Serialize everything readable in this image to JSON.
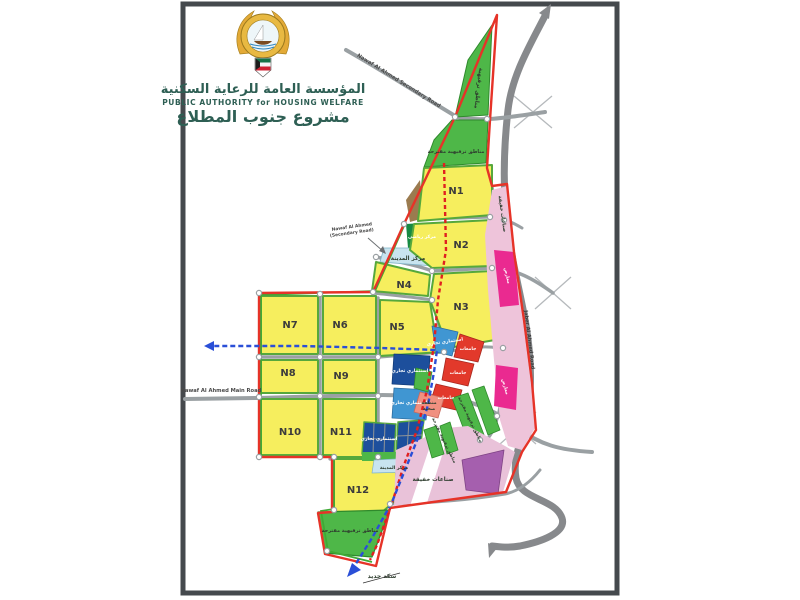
{
  "header": {
    "org_name_ar": "المؤسسة العامة للرعاية السكنية",
    "org_name_en": "PUBLIC AUTHORITY for HOUSING WELFARE",
    "project_name_ar": "مشروع جنوب المطلاع"
  },
  "roads": {
    "nawaf_secondary_top": "Nawaf Al Ahmed Secondary Road",
    "nawaf_secondary_l1": "Nawaf Al Ahmed",
    "nawaf_secondary_l2": "(Secondary Road)",
    "nawaf_main": "Nawaf Al Ahmed Main Road",
    "jaber": "Jaber Al Ahmed Road",
    "railway_ar": "سكة حديد"
  },
  "neighborhoods": {
    "n1": "N1",
    "n2": "N2",
    "n3": "N3",
    "n4": "N4",
    "n5": "N5",
    "n6": "N6",
    "n7": "N7",
    "n8": "N8",
    "n9": "N9",
    "n10": "N10",
    "n11": "N11",
    "n12": "N12"
  },
  "zones": {
    "recreation": "مناطق ترفيهية",
    "recreation_proposed": "مناطق ترفيهية مقترحة",
    "city_center": "مركز المدينة",
    "sports_center": "مركز رياضي",
    "commercial_investment": "استثماري تجاري",
    "universities": "جامعات",
    "health_l1": "منطقة",
    "health_l2": "صحية",
    "exhibitions": "معارض",
    "light_industries": "صناعات خفيفة"
  },
  "colors": {
    "boundary_red": "#e63328",
    "boundary_green": "#3faa35",
    "residential_yellow": "#f6ee5e",
    "recreation_green": "#4eb748",
    "commercial_blue": "#4096d2",
    "commercial_navy": "#1d4f9c",
    "universities_red": "#e2392b",
    "health_salmon": "#f09080",
    "exhibitions_magenta": "#ea2a90",
    "light_industry_pink": "#eec4da",
    "industrial_pale_pink": "#e9c2d9",
    "purple_zone": "#a55fae",
    "city_center_blue": "#c8e4ef",
    "road_gray": "#8f9497",
    "railway_blue": "#2a4fd7"
  }
}
